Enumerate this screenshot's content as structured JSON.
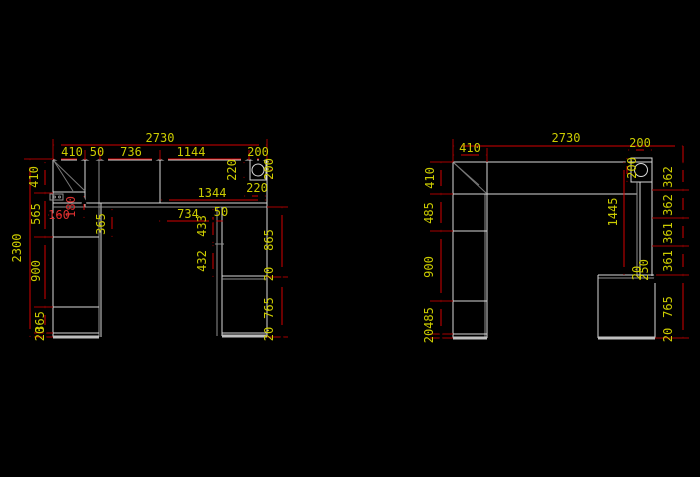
{
  "window": {
    "background": "#000000"
  },
  "colors": {
    "background": "#000000",
    "outline": "#d9d9d9",
    "dimension_line": "#d40000",
    "dimension_text": "#cccc00",
    "dimension_text_red": "#d93030"
  },
  "left_elevation": {
    "overall_width": "2730",
    "overall_height": "2300",
    "top_segments": [
      "410",
      "50",
      "736",
      "1144",
      "200"
    ],
    "left_heights": [
      "410",
      "565",
      "900",
      "365",
      "20"
    ],
    "corner_detail": {
      "width": "160",
      "height": "180"
    },
    "countertop": {
      "depth_left": "220",
      "corner_box_width": "200",
      "depth_front": "220",
      "clear_width": "1344"
    },
    "desk": {
      "opening_width": "734",
      "partition_width": "50",
      "upper_height": "433",
      "lower_height": "432",
      "side_drop": "365"
    },
    "right_heights": [
      "865",
      "20",
      "765",
      "20"
    ]
  },
  "right_elevation": {
    "overall_width": "2730",
    "top_width": "410",
    "left_heights": [
      "410",
      "485",
      "900",
      "485",
      "20"
    ],
    "top_right_width": "200",
    "corner_height": "200",
    "column_height": "1445",
    "shelf_heights": [
      "362",
      "362",
      "361",
      "361"
    ],
    "junction": {
      "a": "250",
      "b": "20"
    },
    "base_heights": [
      "765",
      "20"
    ]
  }
}
